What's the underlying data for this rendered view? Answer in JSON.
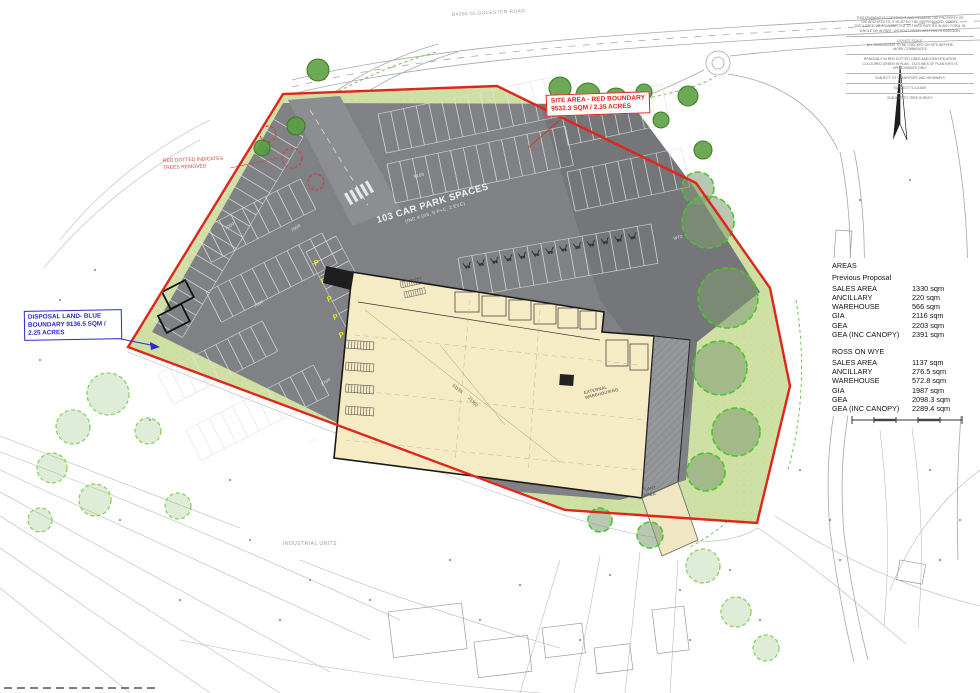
{
  "map": {
    "road_label": "B4260 GLOUCESTER ROAD",
    "industrial_units": "INDUSTRIAL UNITS",
    "site_area_box": {
      "line1": "SITE AREA - RED BOUNDARY",
      "line2": "9532.3 SQM / 2.35 ACRES"
    },
    "disposal_box": {
      "line1": "DISPOSAL LAND- BLUE",
      "line2": "BOUNDARY 9136.5 SQM /",
      "line3": "2.25 ACRES"
    },
    "trees_note": {
      "line1": "RED DOTTED INDICATES",
      "line2": "TREES REMOVED"
    },
    "car_park": {
      "title": "103 CAR PARK SPACES",
      "subtitle": "(INC 4 DIS, 9 P+C, 2 EVC)",
      "p_marking": "P",
      "zone": "WT2",
      "dim_labels": [
        "7000",
        "7000",
        "7000",
        "2700",
        "6100",
        "7000"
      ]
    },
    "building": {
      "external_label_1": "EXTERNAL",
      "external_label_2": "WAREHOUSING",
      "plant_label_1": "PLANT",
      "plant_label_2": "AREA",
      "dim_long": "51150",
      "dim_cross": "21350"
    }
  },
  "areas_table": {
    "title": "AREAS",
    "sections": [
      {
        "heading": "Previous Proposal",
        "rows": [
          [
            "SALES AREA",
            "1330 sqm"
          ],
          [
            "ANCILLARY",
            "220 sqm"
          ],
          [
            "WAREHOUSE",
            "566 sqm"
          ],
          [
            "GIA",
            "2116 sqm"
          ],
          [
            "GEA",
            "2203 sqm"
          ],
          [
            "GEA (INC CANOPY)",
            "2391 sqm"
          ]
        ]
      },
      {
        "heading": "ROSS ON WYE",
        "rows": [
          [
            "SALES AREA",
            "1137 sqm"
          ],
          [
            "ANCILLARY",
            "276.5 sqm"
          ],
          [
            "WAREHOUSE",
            "572.8 sqm"
          ],
          [
            "GIA",
            "1987 sqm"
          ],
          [
            "GEA",
            "2098.3 sqm"
          ],
          [
            "GEA (INC CANOPY)",
            "2289.4 sqm"
          ]
        ]
      }
    ]
  },
  "notes": {
    "groups": [
      [
        "THIS DRAWING IS COPYRIGHT AND REMAINS THE PROPERTY OF",
        "THE ARCHITECTS. IT MUST NOT BE REPRODUCED, COPIED,",
        "DISCLOSED OR TRANSMITTED TO THIRD PARTIES IN ANY FORM, IN",
        "WHOLE OR IN PART, WITHOUT PRIOR WRITTEN PERMISSION."
      ],
      [
        "DO NOT SCALE",
        "ALL DIMENSIONS TO BE CHECKED ON SITE BEFORE",
        "WORK COMMENCES"
      ],
      [
        "REMOVALS IN RED DOTTED LINES AND IDENTIFICATION",
        "COLOURED GREEN IN PLAN - OUTLINES OF PLAN INFO IS",
        "APPROXIMATE ONLY"
      ],
      [
        "SUBJECT TO TRANSPORT AND HIGHWAYS"
      ],
      [
        "SUBJECT TO LEASE"
      ],
      [
        "SUBJECT TO TREE SURVEY"
      ]
    ]
  },
  "colors": {
    "boundary_red": "#e0251b",
    "disposal_blue": "#2a2acc",
    "tarmac_grey": "#7f8184",
    "building_cream": "#f5ebc4",
    "landscape_green": "#cfe0a4",
    "marking_yellow": "#f2e816"
  }
}
